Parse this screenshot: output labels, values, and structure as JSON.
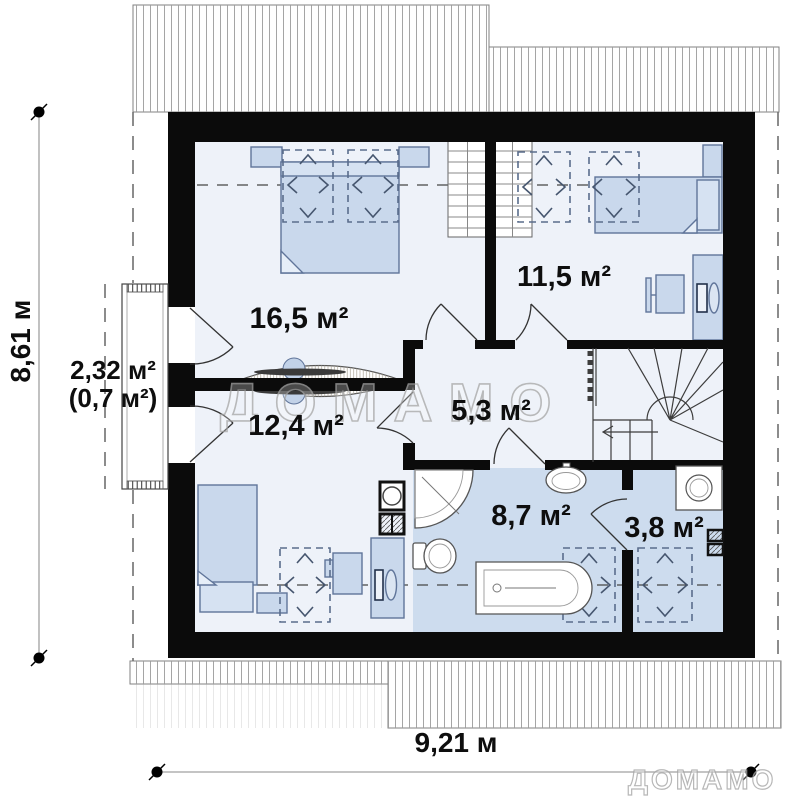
{
  "plan": {
    "title": "attic floor plan",
    "watermark": {
      "text": "ДОМАМО"
    },
    "dimensions": {
      "height_total": "8,61 м",
      "width_total": "9,21 м"
    },
    "rooms": [
      {
        "id": "bedroom-1",
        "area": "16,5 м²"
      },
      {
        "id": "bedroom-2",
        "area": "11,5 м²"
      },
      {
        "id": "balcony",
        "area": "2,32 м²",
        "area_reduced": "(0,7 м²)"
      },
      {
        "id": "bedroom-3",
        "area": "12,4 м²"
      },
      {
        "id": "hallway",
        "area": "5,3 м²"
      },
      {
        "id": "bathroom",
        "area": "8,7 м²"
      },
      {
        "id": "storage",
        "area": "3,8 м²"
      }
    ],
    "colors": {
      "wall": "#0b0b0b",
      "room_fill": "#eef2f9",
      "wet_room_fill": "#cddcee",
      "furniture_fill": "#c9d8ec",
      "furniture_stroke": "#60759a",
      "roof_hatch_stroke": "#9b9b9b"
    }
  }
}
